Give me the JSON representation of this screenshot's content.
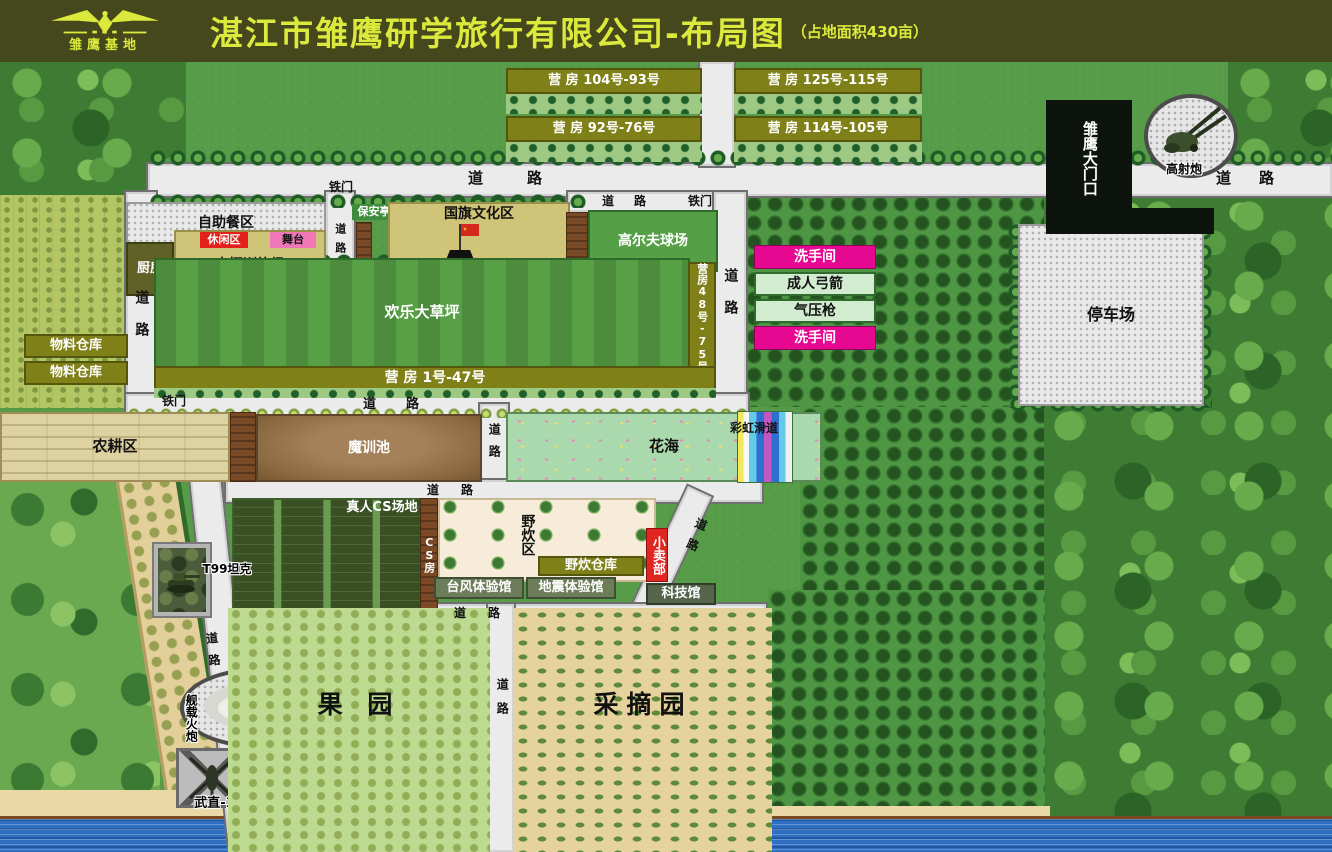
{
  "header": {
    "logo_text": "雏鹰基地",
    "title": "湛江市雏鹰研学旅行有限公司-布局图",
    "subtitle": "（占地面积430亩）"
  },
  "map": {
    "features": [
      {
        "name": "map-base",
        "cls": "f-base",
        "x": 0,
        "y": 62,
        "w": 1332,
        "h": 790
      },
      {
        "name": "forest-top-left",
        "cls": "f-forest",
        "x": 0,
        "y": 62,
        "w": 186,
        "h": 138
      },
      {
        "name": "forest-top-right",
        "cls": "f-forest",
        "x": 1228,
        "y": 62,
        "w": 104,
        "h": 140
      },
      {
        "name": "forest-right",
        "cls": "f-forest",
        "x": 1042,
        "y": 195,
        "w": 290,
        "h": 657
      },
      {
        "name": "meadow-left-bottom",
        "cls": "f-forest2",
        "x": 0,
        "y": 478,
        "w": 160,
        "h": 374
      },
      {
        "name": "crop-field-left",
        "cls": "f-cropfield",
        "x": 0,
        "y": 195,
        "w": 126,
        "h": 213
      },
      {
        "name": "orchard-rows-top",
        "cls": "f-orchrows",
        "x": 744,
        "y": 195,
        "w": 300,
        "h": 212
      },
      {
        "name": "orchard-rows-mid",
        "cls": "f-orchrows",
        "x": 800,
        "y": 407,
        "w": 244,
        "h": 183
      },
      {
        "name": "orchard-rows-bottom",
        "cls": "f-orchrows",
        "x": 768,
        "y": 590,
        "w": 277,
        "h": 245
      },
      {
        "name": "orchard-strip-left",
        "cls": "f-orchtan",
        "x": 116,
        "y": 482,
        "w": 64,
        "h": 336,
        "rot": -9
      },
      {
        "name": "beach-sand",
        "cls": "f-sand",
        "x": 0,
        "y": 790,
        "w": 505,
        "h": 34
      },
      {
        "name": "beach-sand-2",
        "cls": "f-sand",
        "x": 505,
        "y": 806,
        "w": 545,
        "h": 18
      },
      {
        "name": "sea-water",
        "cls": "f-water",
        "x": 0,
        "y": 816,
        "w": 1332,
        "h": 36
      },
      {
        "name": "road-top",
        "cls": "f-roadh",
        "x": 148,
        "y": 164,
        "w": 1184,
        "h": 32
      },
      {
        "name": "road-barracks",
        "cls": "f-roadv",
        "x": 700,
        "y": 62,
        "w": 34,
        "h": 104
      },
      {
        "name": "road-left",
        "cls": "f-roadv",
        "x": 126,
        "y": 192,
        "w": 30,
        "h": 218
      },
      {
        "name": "road-canteen",
        "cls": "f-roadv",
        "x": 326,
        "y": 192,
        "w": 28,
        "h": 88
      },
      {
        "name": "road-golf",
        "cls": "f-roadh",
        "x": 568,
        "y": 192,
        "w": 170,
        "h": 20
      },
      {
        "name": "road-right-col",
        "cls": "f-roadv",
        "x": 714,
        "y": 192,
        "w": 32,
        "h": 216
      },
      {
        "name": "road-below-lawn",
        "cls": "f-roadh",
        "x": 126,
        "y": 394,
        "w": 622,
        "h": 22
      },
      {
        "name": "road-mid",
        "cls": "f-roadv",
        "x": 480,
        "y": 404,
        "w": 28,
        "h": 84
      },
      {
        "name": "road-above-cs",
        "cls": "f-roadh",
        "x": 226,
        "y": 480,
        "w": 536,
        "h": 22
      },
      {
        "name": "road-diag-right",
        "cls": "f-roadv",
        "x": 688,
        "y": 486,
        "w": 26,
        "h": 140,
        "rot": 25
      },
      {
        "name": "road-below-halls",
        "cls": "f-roadh",
        "x": 414,
        "y": 604,
        "w": 352,
        "h": 20
      },
      {
        "name": "road-orchard-mid",
        "cls": "f-roadv",
        "x": 488,
        "y": 604,
        "w": 26,
        "h": 248
      },
      {
        "name": "road-left-diag",
        "cls": "f-roadv",
        "x": 190,
        "y": 478,
        "w": 30,
        "h": 380,
        "rot": -6
      },
      {
        "name": "tree-row-top",
        "cls": "f-treesh",
        "x": 148,
        "y": 150,
        "w": 1184,
        "h": 16
      },
      {
        "name": "tree-row-canteen",
        "cls": "f-treesh",
        "x": 148,
        "y": 194,
        "w": 440,
        "h": 14
      },
      {
        "name": "tree-row-flag-top",
        "cls": "f-treesh",
        "x": 388,
        "y": 196,
        "w": 182,
        "h": 12
      },
      {
        "name": "tree-row-flag-bottom",
        "cls": "f-treesh",
        "x": 388,
        "y": 260,
        "w": 182,
        "h": 12
      },
      {
        "name": "tree-row-lawn-top",
        "cls": "f-treesh",
        "x": 154,
        "y": 254,
        "w": 536,
        "h": 12
      },
      {
        "name": "bush-row-mid",
        "cls": "f-bushes",
        "x": 126,
        "y": 408,
        "w": 620,
        "h": 10
      },
      {
        "name": "tree-col-parking-left",
        "cls": "f-treesv",
        "x": 1008,
        "y": 222,
        "w": 16,
        "h": 186
      },
      {
        "name": "tree-col-parking-right",
        "cls": "f-treesv",
        "x": 1196,
        "y": 222,
        "w": 16,
        "h": 186
      },
      {
        "name": "tree-row-parking-bottom",
        "cls": "f-treesh",
        "x": 1008,
        "y": 396,
        "w": 204,
        "h": 16
      },
      {
        "name": "barracks-bar-1",
        "cls": "f-olivebar fs13",
        "text": "营 房 104号-93号",
        "x": 506,
        "y": 68,
        "w": 196,
        "h": 26
      },
      {
        "name": "barracks-roof-1",
        "cls": "f-stars",
        "x": 506,
        "y": 94,
        "w": 196,
        "h": 20
      },
      {
        "name": "barracks-bar-2",
        "cls": "f-olivebar fs13",
        "text": "营 房 92号-76号",
        "x": 506,
        "y": 116,
        "w": 196,
        "h": 26
      },
      {
        "name": "barracks-roof-2",
        "cls": "f-stars",
        "x": 506,
        "y": 142,
        "w": 196,
        "h": 20
      },
      {
        "name": "barracks-bar-3",
        "cls": "f-olivebar fs13",
        "text": "营 房 125号-115号",
        "x": 734,
        "y": 68,
        "w": 188,
        "h": 26
      },
      {
        "name": "barracks-roof-3",
        "cls": "f-stars",
        "x": 734,
        "y": 94,
        "w": 188,
        "h": 20
      },
      {
        "name": "barracks-bar-4",
        "cls": "f-olivebar fs13",
        "text": "营 房 114号-105号",
        "x": 734,
        "y": 116,
        "w": 188,
        "h": 26
      },
      {
        "name": "barracks-roof-4",
        "cls": "f-stars",
        "x": 734,
        "y": 142,
        "w": 188,
        "h": 20
      },
      {
        "name": "buffet-area",
        "cls": "f-gravel fs14",
        "text": "自助餐区",
        "x": 126,
        "y": 202,
        "w": 200,
        "h": 42
      },
      {
        "name": "kitchen",
        "cls": "f-kitchen white fs13",
        "text": "厨房",
        "x": 126,
        "y": 242,
        "w": 48,
        "h": 54
      },
      {
        "name": "greenhouse-training",
        "cls": "f-khaki tb fs14",
        "text": "大棚训练场",
        "x": 174,
        "y": 230,
        "w": 152,
        "h": 48
      },
      {
        "name": "leisure-zone",
        "cls": "f-redbar fs11",
        "text": "休闲区",
        "x": 200,
        "y": 232,
        "w": 48,
        "h": 16
      },
      {
        "name": "stage",
        "cls": "f-pinkbar fs11",
        "text": "舞台",
        "x": 270,
        "y": 232,
        "w": 46,
        "h": 16
      },
      {
        "name": "guard-booth",
        "cls": "f-greenbar fs11",
        "text": "保安亭",
        "x": 352,
        "y": 204,
        "w": 44,
        "h": 16
      },
      {
        "name": "guard-fence",
        "cls": "f-wall",
        "x": 356,
        "y": 222,
        "w": 16,
        "h": 58
      },
      {
        "name": "flag-culture-zone",
        "cls": "f-khaki tt fs14",
        "text": "国旗文化区",
        "x": 388,
        "y": 202,
        "w": 182,
        "h": 68
      },
      {
        "name": "china-flag",
        "icon": "china-flag",
        "x": 438,
        "y": 222,
        "w": 44,
        "h": 40
      },
      {
        "name": "wall-flag-golf",
        "cls": "f-wall",
        "x": 566,
        "y": 212,
        "w": 22,
        "h": 62
      },
      {
        "name": "golf-range",
        "cls": "f-golf white fs14",
        "text": "高尔夫球场",
        "x": 588,
        "y": 210,
        "w": 130,
        "h": 62
      },
      {
        "name": "obstacle-race",
        "cls": "f-khaki fs14",
        "text": "障碍比赛",
        "x": 442,
        "y": 263,
        "w": 164,
        "h": 24
      },
      {
        "name": "happy-lawn",
        "cls": "f-lawn white fs15",
        "text": "欢乐大草坪",
        "x": 154,
        "y": 258,
        "w": 536,
        "h": 110
      },
      {
        "name": "barracks-48-75",
        "cls": "f-olivebar vt fs11",
        "text": "营房48号-75号",
        "x": 688,
        "y": 262,
        "w": 28,
        "h": 110
      },
      {
        "name": "barracks-1-47",
        "cls": "f-olivebar fs14",
        "text": "营 房 1号-47号",
        "x": 154,
        "y": 366,
        "w": 562,
        "h": 24
      },
      {
        "name": "barracks-1-47-roof",
        "cls": "f-stars",
        "x": 154,
        "y": 388,
        "w": 562,
        "h": 10
      },
      {
        "name": "material-store-1",
        "cls": "f-olivebar fs13",
        "text": "物料仓库",
        "x": 24,
        "y": 334,
        "w": 104,
        "h": 24
      },
      {
        "name": "material-store-2",
        "cls": "f-olivebar fs13",
        "text": "物料仓库",
        "x": 24,
        "y": 361,
        "w": 104,
        "h": 24
      },
      {
        "name": "restroom-1",
        "cls": "f-magenta fs14",
        "text": "洗手间",
        "x": 754,
        "y": 245,
        "w": 122,
        "h": 24
      },
      {
        "name": "adult-archery",
        "cls": "f-lgreen fs14",
        "text": "成人弓箭",
        "x": 754,
        "y": 272,
        "w": 122,
        "h": 24
      },
      {
        "name": "air-gun",
        "cls": "f-lgreen fs14",
        "text": "气压枪",
        "x": 754,
        "y": 299,
        "w": 122,
        "h": 24
      },
      {
        "name": "restroom-2",
        "cls": "f-magenta fs14",
        "text": "洗手间",
        "x": 754,
        "y": 326,
        "w": 122,
        "h": 24
      },
      {
        "name": "parking-lot",
        "cls": "f-gravel fs16",
        "text": "停车场",
        "x": 1018,
        "y": 224,
        "w": 186,
        "h": 182
      },
      {
        "name": "main-gate",
        "cls": "f-gate vt white fs15",
        "text": "雏鹰大门口",
        "x": 1046,
        "y": 100,
        "w": 86,
        "h": 116
      },
      {
        "name": "gate-wall",
        "cls": "f-gate",
        "x": 1046,
        "y": 208,
        "w": 168,
        "h": 26
      },
      {
        "name": "aa-gun-pad",
        "cls": "f-gravelround",
        "x": 1144,
        "y": 94,
        "w": 94,
        "h": 84
      },
      {
        "name": "aa-gun",
        "icon": "aa-gun",
        "x": 1154,
        "y": 100,
        "w": 76,
        "h": 60
      },
      {
        "name": "aa-gun-label",
        "cls": "f-lab outl fs12",
        "text": "高射炮",
        "x": 1152,
        "y": 162,
        "w": 64,
        "h": 15
      },
      {
        "name": "farming-zone",
        "cls": "f-farm fs15",
        "text": "农耕区",
        "x": 0,
        "y": 412,
        "w": 230,
        "h": 70
      },
      {
        "name": "wall-farm",
        "cls": "f-wall",
        "x": 230,
        "y": 412,
        "w": 26,
        "h": 70
      },
      {
        "name": "mud-training-pool",
        "cls": "f-mud white fs14",
        "text": "魔训池",
        "x": 256,
        "y": 414,
        "w": 226,
        "h": 68
      },
      {
        "name": "flower-sea",
        "cls": "f-flower fs15",
        "text": "花海",
        "x": 506,
        "y": 412,
        "w": 316,
        "h": 70
      },
      {
        "name": "rainbow-slide",
        "cls": "f-rainbow",
        "x": 738,
        "y": 412,
        "w": 54,
        "h": 70
      },
      {
        "name": "rainbow-slide-label",
        "cls": "f-lab fs12",
        "text": "彩虹滑道",
        "x": 712,
        "y": 420,
        "w": 84,
        "h": 16
      },
      {
        "name": "cs-field",
        "cls": "f-cs",
        "x": 232,
        "y": 498,
        "w": 190,
        "h": 112
      },
      {
        "name": "cs-field-label",
        "cls": "f-lab white fs13",
        "text": "真人CS场地",
        "x": 330,
        "y": 500,
        "w": 104,
        "h": 16
      },
      {
        "name": "cs-house",
        "cls": "f-wall vt fs11",
        "text": "CS房",
        "x": 420,
        "y": 498,
        "w": 18,
        "h": 112
      },
      {
        "name": "picnic-zone",
        "cls": "f-cream",
        "x": 438,
        "y": 498,
        "w": 218,
        "h": 84
      },
      {
        "name": "picnic-zone-label",
        "cls": "f-lab vt fs14",
        "text": "野炊区",
        "x": 516,
        "y": 504,
        "w": 22,
        "h": 62
      },
      {
        "name": "picnic-warehouse",
        "cls": "f-olivebar fs13",
        "text": "野炊仓库",
        "x": 538,
        "y": 556,
        "w": 106,
        "h": 20
      },
      {
        "name": "kiosk",
        "cls": "f-redshop vt fs13",
        "text": "小卖部",
        "x": 646,
        "y": 528,
        "w": 22,
        "h": 54
      },
      {
        "name": "typhoon-hall",
        "cls": "f-greybar fs13",
        "text": "台风体验馆",
        "x": 434,
        "y": 577,
        "w": 90,
        "h": 22
      },
      {
        "name": "earthquake-hall",
        "cls": "f-greybar fs13",
        "text": "地震体验馆",
        "x": 526,
        "y": 577,
        "w": 90,
        "h": 22
      },
      {
        "name": "science-hall",
        "cls": "f-greybar2 fs13",
        "text": "科技馆",
        "x": 646,
        "y": 583,
        "w": 70,
        "h": 22
      },
      {
        "name": "t99-tank-box",
        "cls": "f-photobox",
        "x": 158,
        "y": 548,
        "w": 48,
        "h": 64
      },
      {
        "name": "t99-tank",
        "icon": "t99-tank",
        "x": 162,
        "y": 564,
        "w": 40,
        "h": 30
      },
      {
        "name": "t99-tank-label",
        "cls": "f-lab outl fs12",
        "text": "T99坦克",
        "x": 194,
        "y": 562,
        "w": 66,
        "h": 14
      },
      {
        "name": "j20-pad",
        "cls": "f-pad",
        "x": 310,
        "y": 614,
        "w": 82,
        "h": 94
      },
      {
        "name": "j20-jet",
        "icon": "j20-jet",
        "x": 318,
        "y": 624,
        "w": 66,
        "h": 80
      },
      {
        "name": "j20-label",
        "cls": "f-lab outl fs13",
        "text": "歼-20",
        "x": 324,
        "y": 616,
        "w": 52,
        "h": 15
      },
      {
        "name": "naval-gun-pad",
        "cls": "f-gravelround",
        "x": 180,
        "y": 668,
        "w": 152,
        "h": 80
      },
      {
        "name": "naval-gun",
        "icon": "naval-gun",
        "x": 196,
        "y": 676,
        "w": 226,
        "h": 56
      },
      {
        "name": "naval-gun-label",
        "cls": "f-lab vt outl fs12",
        "text": "舰载火炮",
        "x": 182,
        "y": 688,
        "w": 18,
        "h": 60
      },
      {
        "name": "helipad",
        "cls": "f-pad f-padx",
        "x": 176,
        "y": 748,
        "w": 72,
        "h": 60
      },
      {
        "name": "helicopter",
        "icon": "helicopter",
        "x": 182,
        "y": 752,
        "w": 60,
        "h": 52
      },
      {
        "name": "helicopter-label",
        "cls": "f-lab outl fs13",
        "text": "武直-10",
        "x": 186,
        "y": 796,
        "w": 66,
        "h": 15
      },
      {
        "name": "orchard",
        "cls": "f-orchlight pt80 fs24",
        "text": "果 园",
        "x": 228,
        "y": 608,
        "w": 262,
        "h": 244
      },
      {
        "name": "picking-garden",
        "cls": "f-pick pt80 fs24",
        "text": "采摘园",
        "x": 514,
        "y": 608,
        "w": 258,
        "h": 244
      },
      {
        "name": "road-label-top",
        "cls": "f-lab fs15 ls40",
        "text": "道路",
        "x": 452,
        "y": 168,
        "w": 150,
        "h": 22
      },
      {
        "name": "road-label-gate",
        "cls": "f-lab fs15 ls28",
        "text": "道路",
        "x": 1204,
        "y": 168,
        "w": 110,
        "h": 22
      },
      {
        "name": "road-label-golf",
        "cls": "f-lab fs12 ls20",
        "text": "道路",
        "x": 590,
        "y": 194,
        "w": 88,
        "h": 15
      },
      {
        "name": "iron-gate-golf",
        "cls": "f-lab fs12",
        "text": "铁门",
        "x": 682,
        "y": 194,
        "w": 36,
        "h": 15
      },
      {
        "name": "iron-gate-top",
        "cls": "f-lab fs12",
        "text": "铁门",
        "x": 322,
        "y": 180,
        "w": 38,
        "h": 15
      },
      {
        "name": "road-label-left",
        "cls": "f-lab vt fs14 ls18",
        "text": "道路",
        "x": 130,
        "y": 278,
        "w": 22,
        "h": 88
      },
      {
        "name": "road-label-canteen",
        "cls": "f-lab vt fs11 ls8",
        "text": "道路",
        "x": 330,
        "y": 214,
        "w": 20,
        "h": 56
      },
      {
        "name": "road-label-rightcol",
        "cls": "f-lab vt fs14 ls18",
        "text": "道路",
        "x": 718,
        "y": 256,
        "w": 24,
        "h": 88
      },
      {
        "name": "road-label-mid",
        "cls": "f-lab vt fs12 ls10",
        "text": "道路",
        "x": 484,
        "y": 414,
        "w": 20,
        "h": 62
      },
      {
        "name": "road-label-belowlawn",
        "cls": "f-lab fs13 ls30",
        "text": "道路",
        "x": 348,
        "y": 396,
        "w": 116,
        "h": 17
      },
      {
        "name": "iron-gate-belowlawn",
        "cls": "f-lab fs12",
        "text": "铁门",
        "x": 156,
        "y": 394,
        "w": 36,
        "h": 15
      },
      {
        "name": "road-label-abovecs",
        "cls": "f-lab fs12 ls22",
        "text": "道路",
        "x": 418,
        "y": 482,
        "w": 86,
        "h": 16
      },
      {
        "name": "road-label-diag",
        "cls": "f-lab vt fs12 ls10",
        "text": "道路",
        "x": 696,
        "y": 508,
        "w": 20,
        "h": 58,
        "rot": 22
      },
      {
        "name": "road-label-belowhalls",
        "cls": "f-lab fs12 ls22",
        "text": "道路",
        "x": 444,
        "y": 605,
        "w": 88,
        "h": 16
      },
      {
        "name": "road-label-leftdiag",
        "cls": "f-lab vt fs12 ls10",
        "text": "道路",
        "x": 200,
        "y": 626,
        "w": 20,
        "h": 58,
        "rot": -6
      },
      {
        "name": "road-label-orchardmid",
        "cls": "f-lab vt fs12 ls12",
        "text": "道路",
        "x": 492,
        "y": 672,
        "w": 20,
        "h": 60
      }
    ]
  }
}
